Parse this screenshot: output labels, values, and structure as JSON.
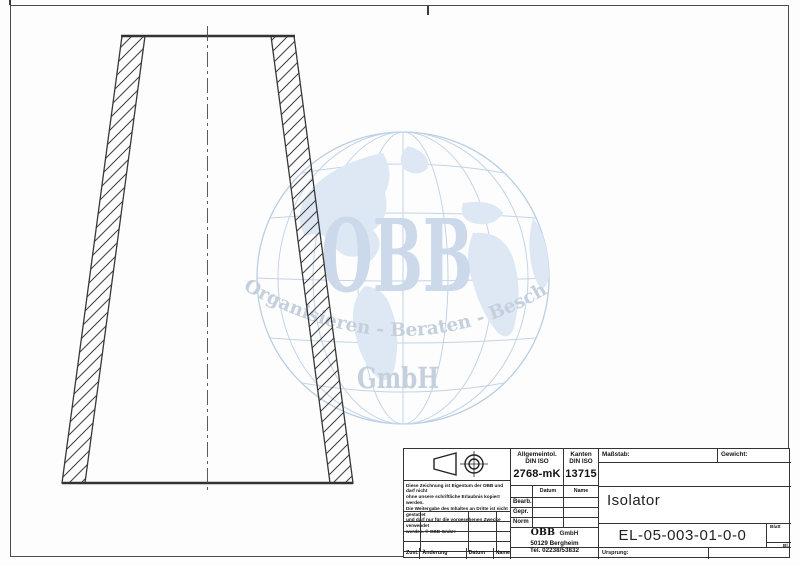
{
  "colors": {
    "wm-grid": "#c2d4e8",
    "wm-land": "#dde8f4",
    "wm-strong": "#cbd9ea",
    "wm-text": "#c5cfdd"
  },
  "watermark": {
    "name": "OBB",
    "slogan": "Organisieren - Beraten - Beschaffen",
    "suffix": "GmbH"
  },
  "title_block": {
    "general_tolerance": {
      "line1": "Allgemeintol.",
      "line2": "DIN ISO",
      "value": "2768-mK"
    },
    "edges": {
      "line1": "Kanten",
      "line2": "DIN ISO",
      "value": "13715"
    },
    "scale_label": "Maßstab:",
    "weight_label": "Gewicht:",
    "part_name": "Isolator",
    "drawing_number": "EL-05-003-01-0-0",
    "sheet_label": "Blatt",
    "sheet_abbr": "Bl.",
    "origin_label": "Ursprung:",
    "col_date": "Datum",
    "col_name": "Name",
    "rows": {
      "bearb": "Bearb.",
      "gepr": "Gepr.",
      "norm": "Norm"
    },
    "revision": {
      "zust": "Zust.",
      "change": "Änderung",
      "date": "Datum",
      "name": "Name"
    },
    "company": {
      "name": "OBB",
      "suffix": "GmbH",
      "address": "50129 Bergheim",
      "phone": "Tel. 02238/53832"
    },
    "disclaimer_lines": [
      "Diese Zeichnung ist Eigentum der OBB und darf nicht",
      "ohne unsere schriftliche Erlaubnis kopiert werden.",
      "Die Weitergabe des Inhaltes an Dritte ist nicht gestattet",
      "und darf nur für die vorgesehenen Zwecke verwendet",
      "werden. © OBB GmbH"
    ]
  }
}
